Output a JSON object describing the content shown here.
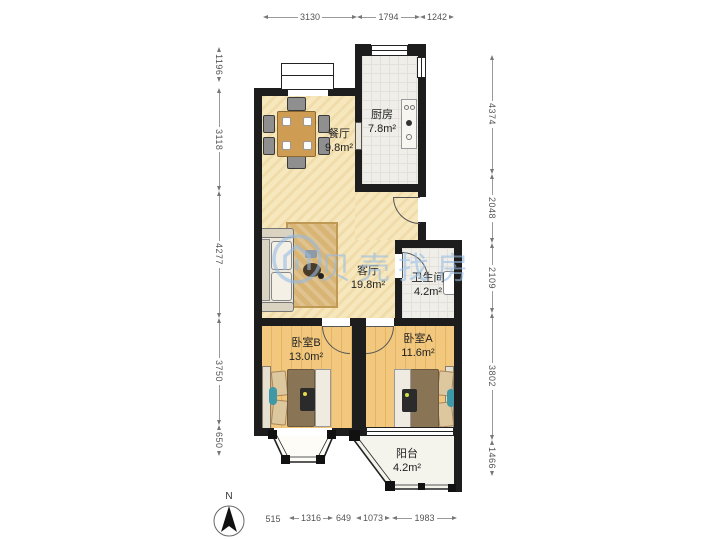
{
  "watermark": {
    "text": "贝壳找房",
    "logo": "beike-house-logo"
  },
  "compass": {
    "label": "N"
  },
  "rooms": {
    "dining": {
      "name": "餐厅",
      "area": "9.8m²"
    },
    "kitchen": {
      "name": "厨房",
      "area": "7.8m²"
    },
    "living": {
      "name": "客厅",
      "area": "19.8m²"
    },
    "bathroom": {
      "name": "卫生间",
      "area": "4.2m²"
    },
    "bedroom_b": {
      "name": "卧室B",
      "area": "13.0m²"
    },
    "bedroom_a": {
      "name": "卧室A",
      "area": "11.6m²"
    },
    "balcony": {
      "name": "阳台",
      "area": "4.2m²"
    }
  },
  "dimensions": {
    "top": [
      "3130",
      "1794",
      "1242"
    ],
    "left": [
      "1196",
      "3118",
      "4277",
      "3750",
      "650"
    ],
    "right": [
      "4374",
      "2048",
      "2109",
      "3802",
      "1466"
    ],
    "bottom_label": "515",
    "bottom": [
      "1316",
      "649",
      "1073",
      "1983"
    ]
  },
  "colors": {
    "wall": "#1d1d1d",
    "warm_floor": "#F7E7BD",
    "wood_floor": "#F2C87E",
    "tile_floor": "#EFEEE8",
    "accent_teal": "#3E98A5",
    "watermark_blue": "#96BCE4"
  }
}
